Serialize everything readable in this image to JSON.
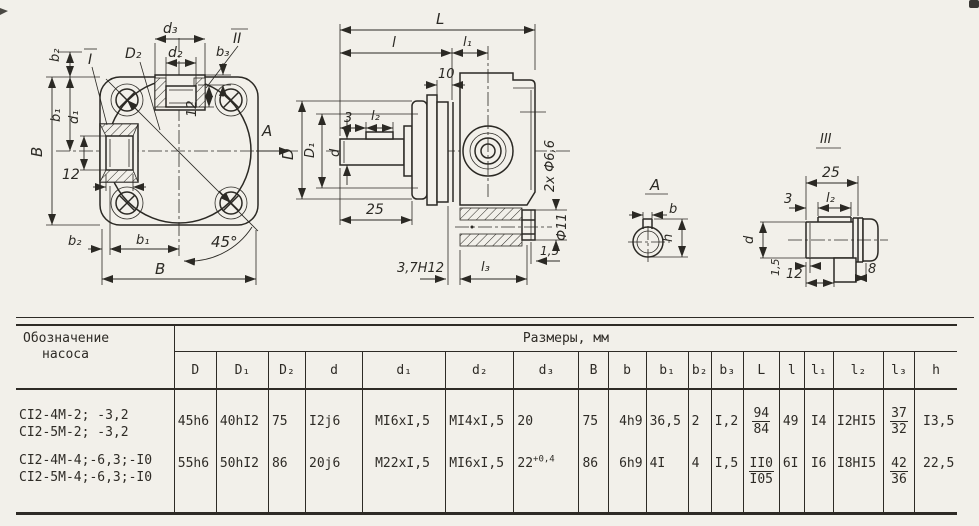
{
  "drawing": {
    "front": {
      "b2_top": "b₂",
      "view_i": "I",
      "D2": "D₂",
      "d3": "d₃",
      "view_ii": "II",
      "d2": "d₂",
      "b3": "b₃",
      "B_side": "B",
      "b1_side": "b₁",
      "d1": "d₁",
      "dim12_side": "12",
      "dim12_top": "12",
      "arrow_a": "A",
      "angle45": "45°",
      "b2_bot": "b₂",
      "b1_bot": "b₁",
      "B_bot": "B"
    },
    "side": {
      "L": "L",
      "l": "l",
      "l1": "l₁",
      "dim10": "10",
      "D": "D",
      "D1": "D₁",
      "dim3": "3",
      "l2": "l₂",
      "d": "d",
      "dim25": "25",
      "holes": "2x Ф6,6",
      "phi11": "Ф11",
      "dim15": "1,5",
      "groove": "3,7H12",
      "l3": "l₃"
    },
    "viewA": {
      "label": "A",
      "b": "b",
      "h": "h"
    },
    "sec3": {
      "label": "III",
      "dim25": "25",
      "dim3": "3",
      "l2": "l₂",
      "d": "d",
      "dim15": "1,5",
      "dim12": "12",
      "dim8": "8"
    }
  },
  "table": {
    "name_h1": "Обозначение",
    "name_h2": "насоса",
    "sizes_header": "Размеры, мм",
    "cols": [
      "D",
      "D₁",
      "D₂",
      "d",
      "d₁",
      "d₂",
      "d₃",
      "B",
      "b",
      "b₁",
      "b₂",
      "b₃",
      "L",
      "l",
      "l₁",
      "l₂",
      "l₃",
      "h"
    ],
    "r0": {
      "names": [
        "CI2-4M-2; -3,2",
        "CI2-5M-2; -3,2"
      ],
      "D": "45h6",
      "D1": "40hI2",
      "D2": "75",
      "d": "I2j6",
      "d1": "MI6xI,5",
      "d2": "MI4xI,5",
      "d3": "20",
      "d3_sup": "",
      "B": "75",
      "b": "4h9",
      "b1": "36,5",
      "b2": "2",
      "b3": "I,2",
      "L_top": "94",
      "L_bot": "84",
      "l": "49",
      "l1": "I4",
      "l2": "I2HI5",
      "l3_top": "37",
      "l3_bot": "32",
      "h": "I3,5"
    },
    "r1": {
      "names": [
        "CI2-4M-4;-6,3;-I0",
        "CI2-5M-4;-6,3;-I0"
      ],
      "D": "55h6",
      "D1": "50hI2",
      "D2": "86",
      "d": "20j6",
      "d1": "M22xI,5",
      "d2": "MI6xI,5",
      "d3": "22",
      "d3_sup": "+0,4",
      "B": "86",
      "b": "6h9",
      "b1": "4I",
      "b2": "4",
      "b3": "I,5",
      "L_top": "II0",
      "L_bot": "I05",
      "l": "6I",
      "l1": "I6",
      "l2": "I8HI5",
      "l3_top": "42",
      "l3_bot": "36",
      "h": "22,5"
    }
  }
}
